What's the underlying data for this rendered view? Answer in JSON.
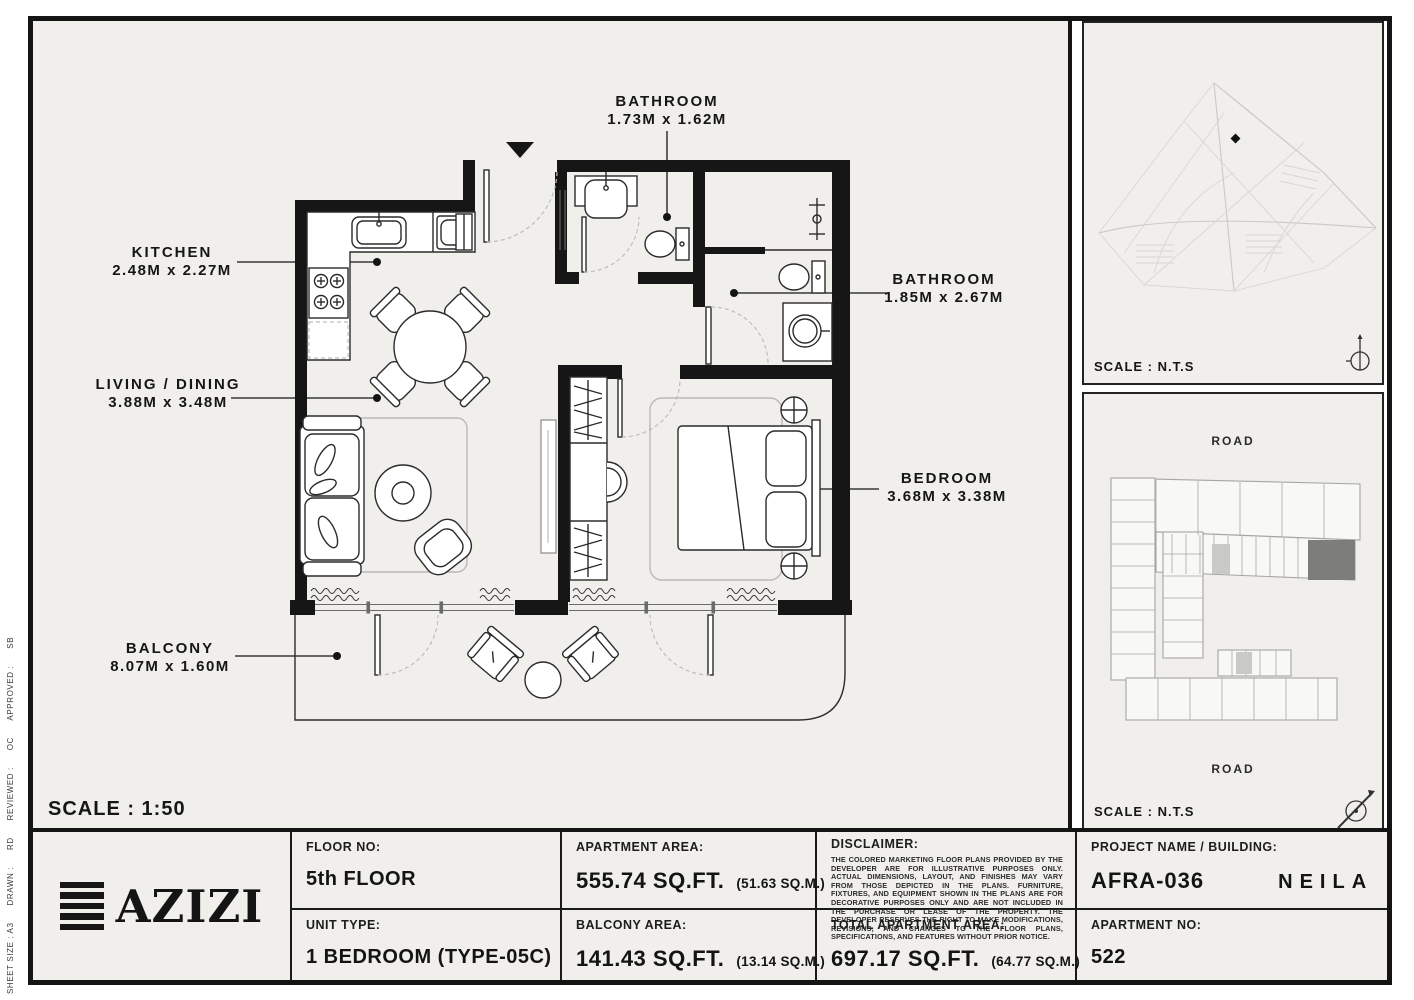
{
  "colors": {
    "paper": "#ffffff",
    "panel_bg": "#f0efec",
    "ink": "#161616",
    "wall": "#161616",
    "faint_line": "#c9c9c6",
    "highlight_unit": "#7d7d7b"
  },
  "icons": {
    "entry_marker": "entry-arrow-icon",
    "compass": "north-compass-icon"
  },
  "side_strip": {
    "text": "SHEET SIZE : A3      DRAWN :      RD      REVIEWED :      OC      APPROVED :      SB"
  },
  "plan": {
    "scale_label": "SCALE : 1:50",
    "rooms": [
      {
        "name": "KITCHEN",
        "dims": "2.48M x 2.27M"
      },
      {
        "name": "LIVING / DINING",
        "dims": "3.88M x 3.48M"
      },
      {
        "name": "BALCONY",
        "dims": "8.07M x 1.60M"
      },
      {
        "name": "BATHROOM",
        "dims": "1.73M x 1.62M"
      },
      {
        "name": "BATHROOM",
        "dims": "1.85M x 2.67M"
      },
      {
        "name": "BEDROOM",
        "dims": "3.68M x 3.38M"
      }
    ]
  },
  "site_map_panel": {
    "scale_label": "SCALE : N.T.S"
  },
  "key_plan_panel": {
    "scale_label": "SCALE : N.T.S",
    "road_top": "ROAD",
    "road_bottom": "ROAD"
  },
  "title_block": {
    "brand": "AZIZI",
    "floor": {
      "label": "FLOOR NO:",
      "value": "5th FLOOR"
    },
    "unit": {
      "label": "UNIT TYPE:",
      "value": "1 BEDROOM (TYPE-05C)"
    },
    "apartment_area": {
      "label": "APARTMENT AREA:",
      "value": "555.74 SQ.FT.",
      "metric": "(51.63 SQ.M.)"
    },
    "balcony_area": {
      "label": "BALCONY AREA:",
      "value": "141.43 SQ.FT.",
      "metric": "(13.14 SQ.M.)"
    },
    "disclaimer": {
      "label": "DISCLAIMER:",
      "text": "THE COLORED MARKETING FLOOR PLANS PROVIDED BY THE DEVELOPER ARE FOR ILLUSTRATIVE PURPOSES ONLY. ACTUAL DIMENSIONS, LAYOUT, AND FINISHES MAY VARY FROM THOSE DEPICTED IN THE PLANS. FURNITURE, FIXTURES, AND EQUIPMENT SHOWN IN THE PLANS ARE FOR DECORATIVE PURPOSES ONLY AND ARE NOT INCLUDED IN THE PURCHASE OR LEASE OF THE PROPERTY. THE DEVELOPER RESERVES THE RIGHT TO MAKE MODIFICATIONS, REVISIONS, AND CHANGES TO THE FLOOR PLANS, SPECIFICATIONS, AND FEATURES WITHOUT PRIOR NOTICE."
    },
    "total_area": {
      "label": "TOTAL APARTMENT AREA:",
      "value": "697.17 SQ.FT.",
      "metric": "(64.77 SQ.M.)"
    },
    "project": {
      "label": "PROJECT NAME / BUILDING:",
      "value": "AFRA-036",
      "building": "NEILA"
    },
    "apartment_no": {
      "label": "APARTMENT NO:",
      "value": "522"
    }
  }
}
